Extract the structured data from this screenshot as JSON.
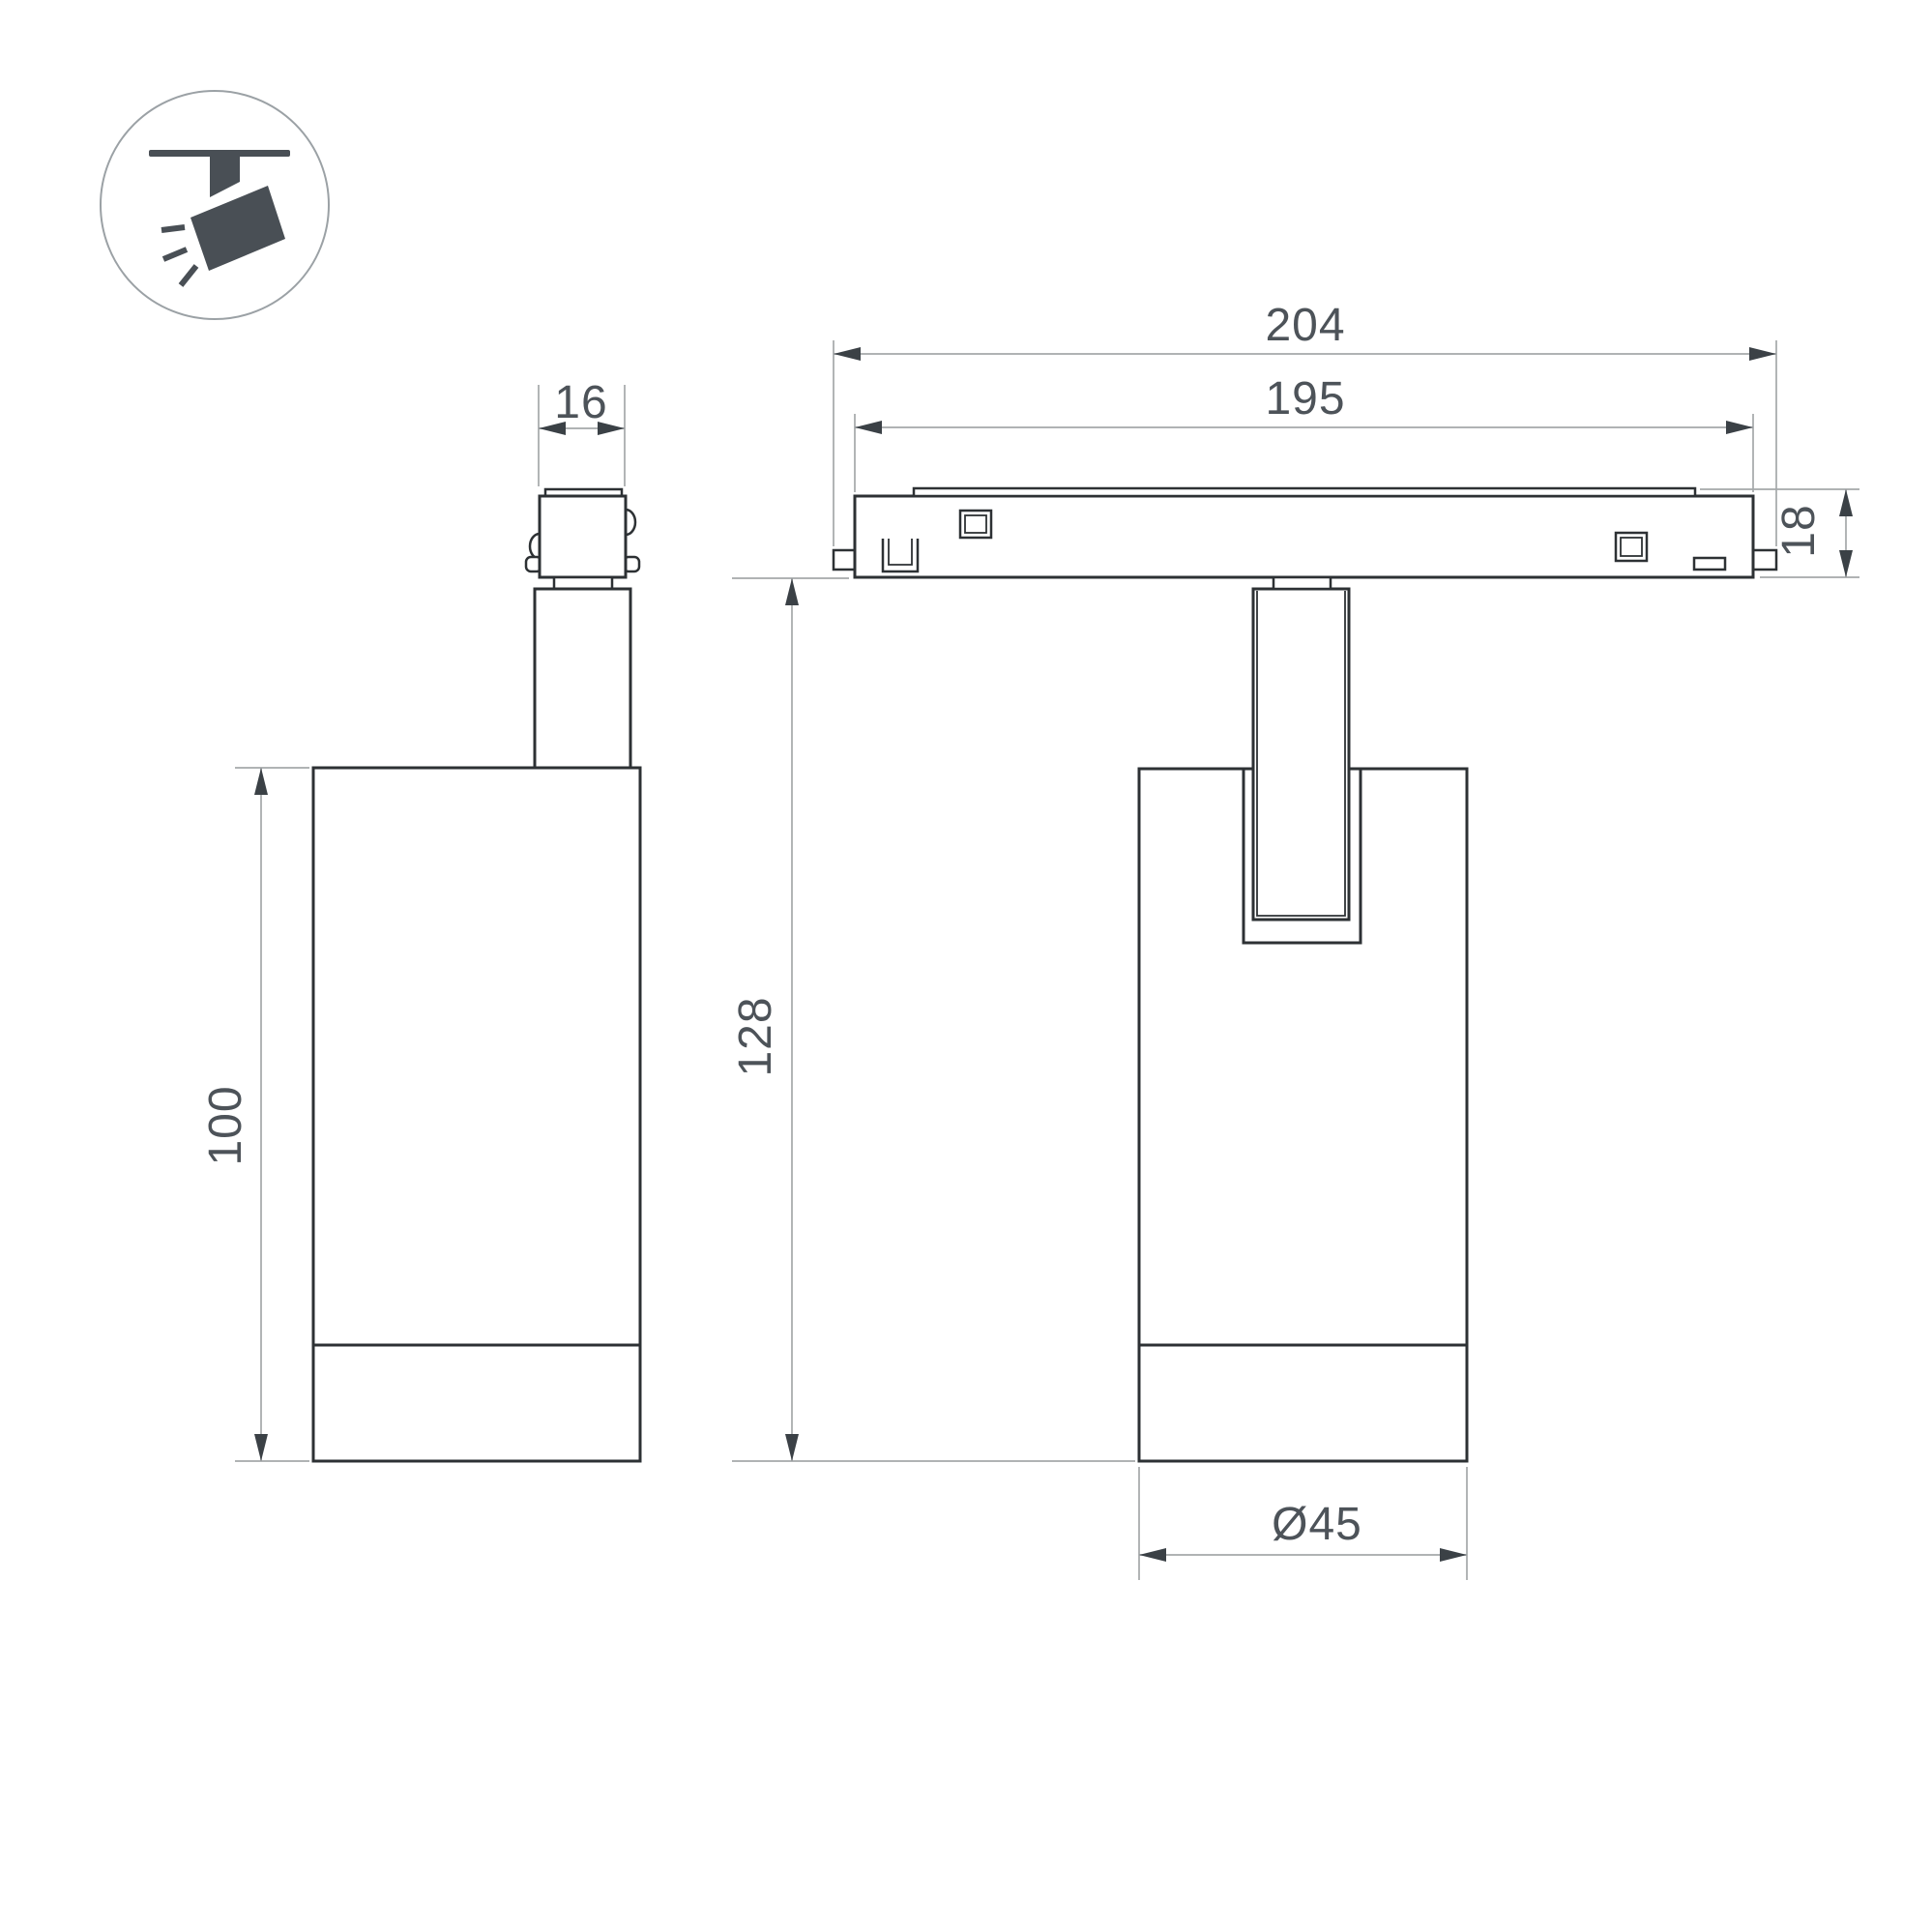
{
  "drawing": {
    "type": "technical-dimension-drawing",
    "subject": "magnetic track spotlight, side view and front view with track profile",
    "colors": {
      "background": "#ffffff",
      "object_line": "#2d3134",
      "dimension_line": "#a5a8aa",
      "arrow": "#3b4146",
      "text": "#4d5359",
      "icon": "#494f55",
      "icon_circle": "#9ba1a5"
    }
  },
  "icon": {
    "name": "track-spotlight-icon"
  },
  "dimensions": {
    "stem_width": "16",
    "track_length_outer": "204",
    "track_length_inner": "195",
    "track_height": "18",
    "body_height": "100",
    "overall_height": "128",
    "body_diameter": "Ø45"
  }
}
